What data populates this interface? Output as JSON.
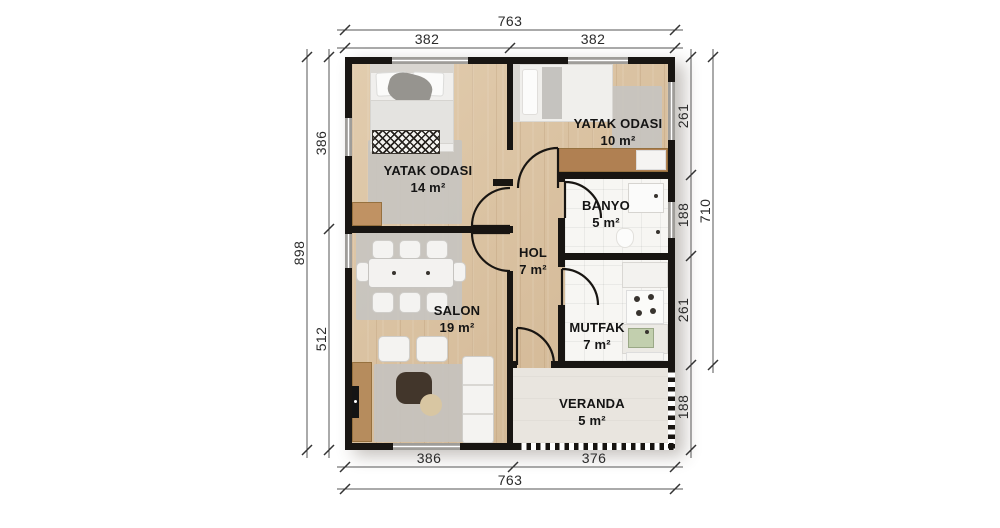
{
  "plan": {
    "rooms": [
      {
        "id": "bedroom-1",
        "label": "YATAK ODASI",
        "area": "14 m²"
      },
      {
        "id": "bedroom-2",
        "label": "YATAK ODASI",
        "area": "10 m²"
      },
      {
        "id": "bathroom",
        "label": "BANYO",
        "area": "5 m²"
      },
      {
        "id": "hall",
        "label": "HOL",
        "area": "7 m²"
      },
      {
        "id": "living-room",
        "label": "SALON",
        "area": "19 m²"
      },
      {
        "id": "kitchen",
        "label": "MUTFAK",
        "area": "7 m²"
      },
      {
        "id": "veranda",
        "label": "VERANDA",
        "area": "5 m²"
      }
    ],
    "dimensions": {
      "top_total": "763",
      "top_left": "382",
      "top_right": "382",
      "left_total": "898",
      "left_top": "386",
      "left_bottom": "512",
      "right_top": "261",
      "right_upper_mid": "188",
      "right_lower_mid": "261",
      "right_bottom": "188",
      "right_total": "710",
      "bottom_left": "386",
      "bottom_right": "376",
      "bottom_total": "763"
    },
    "colors": {
      "wall": "#181512",
      "wood_floor": "#d8bf9d",
      "tile_floor": "#f7f6f3",
      "veranda_floor": "#e9e5df",
      "window": "#9f9d99",
      "rug": "#c7c4c0",
      "dimension_text": "#2b2b2b",
      "label_text": "#141414"
    }
  }
}
